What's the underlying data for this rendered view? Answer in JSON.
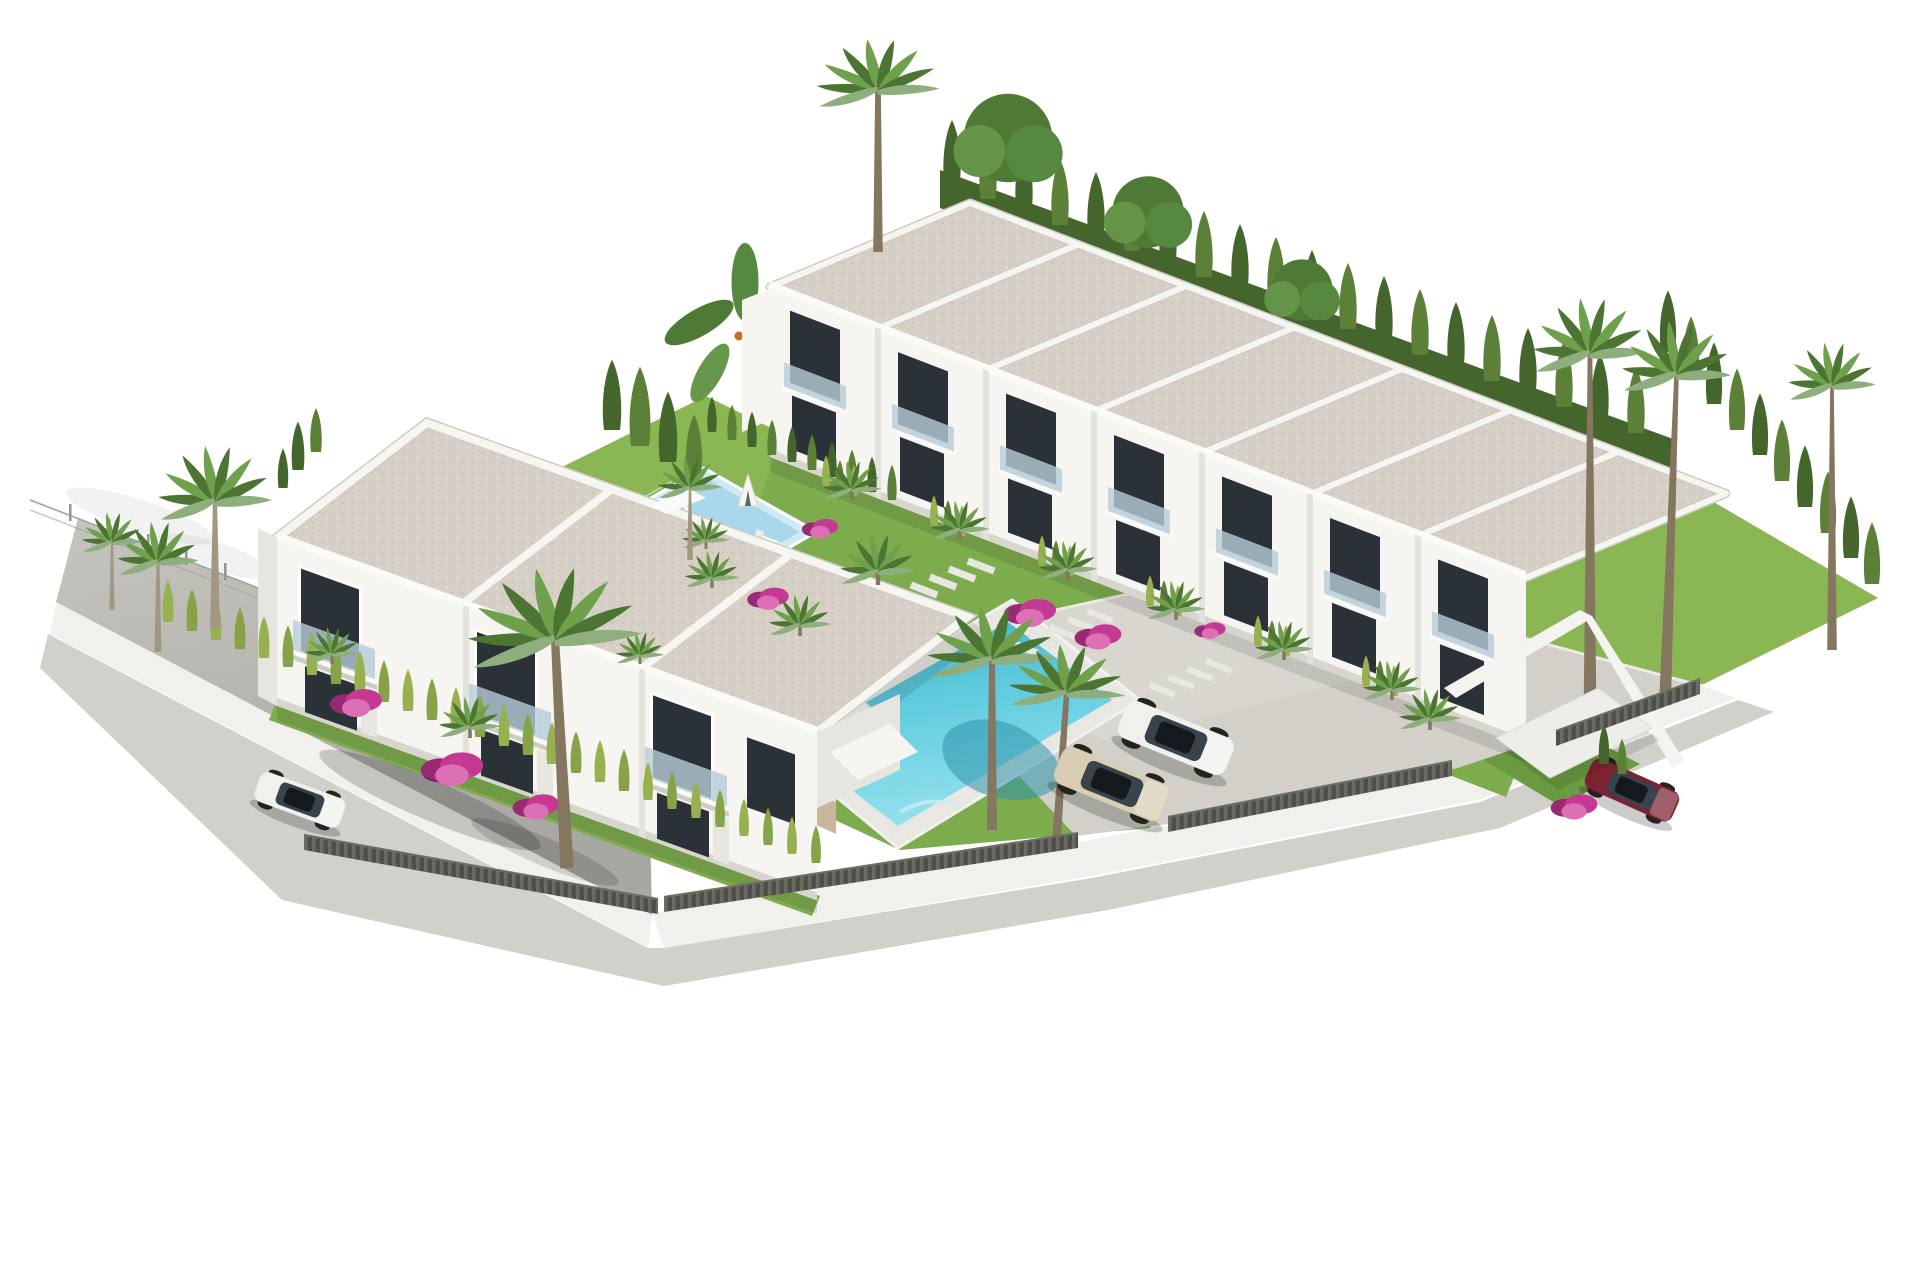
{
  "scene": {
    "type": "3d-architectural-render",
    "subject": "aerial-view-white-townhouse-complex-with-pools-gardens-palms-parking"
  },
  "palette": {
    "bg": "#ffffff",
    "roof": "#d6cfc5",
    "roofSpeck": "#c7bfb3",
    "roofSpeck2": "#e6e0d6",
    "white": "#f6f5f2",
    "wallShade": "#e7e5e0",
    "wallDark": "#d8d5cf",
    "win": "#2b3237",
    "glassBal": "#b7ccd6",
    "road": "#b5b2ad",
    "roadLight": "#c9c7c2",
    "sidewalk": "#d2d0cb",
    "platform": "#d3d0ca",
    "platformLight": "#dedbd5",
    "lawn": "#7dac4d",
    "lawnLight": "#8ab653",
    "lawnDark": "#6a9a41",
    "hedgeDark": "#44662d",
    "hedgeMid": "#5d8038",
    "hedgeBright": "#97b050",
    "hedgeBright2": "#86a348",
    "palmA": "#6fa04c",
    "palmB": "#4c7433",
    "palmC": "#8fae7e",
    "trunk": "#a29781",
    "trunkDark": "#84765f",
    "stone": "#c8b79c",
    "stoneDark": "#b19f82",
    "slat": "#4f4f4a",
    "slatLight": "#6b6b64",
    "wire": "#9aa3a1",
    "boug": "#c43a92",
    "bougDark": "#992973",
    "bougLight": "#dd6fb6",
    "pool": "#57c8da",
    "poolDeep": "#2f9fb8",
    "poolLight": "#9fe0ea",
    "kidDeck": "#aad7e9",
    "kidDeckLight": "#cfeaf4",
    "carWhite": "#f0f0ed",
    "carTan": "#d9cdb4",
    "carRed": "#7c2230",
    "carGlass": "#39434c"
  }
}
